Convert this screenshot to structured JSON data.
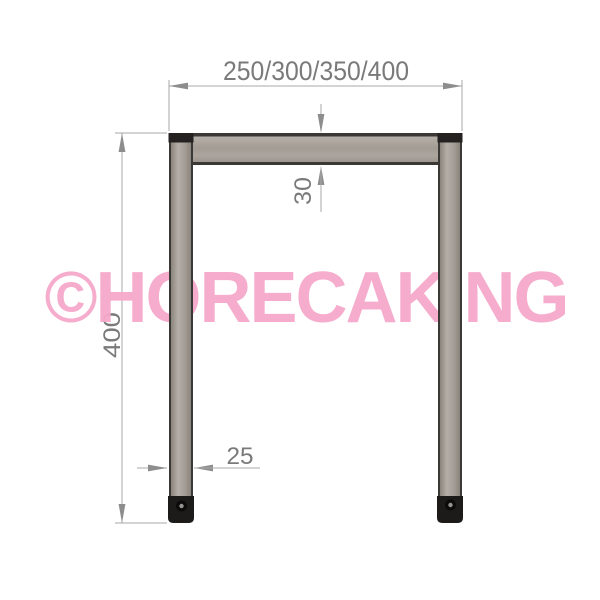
{
  "watermark": {
    "text": "©HORECAKING",
    "color": "#f6a9cb"
  },
  "drawing": {
    "title": "frame-front-view-technical-drawing",
    "dimensions": {
      "top_width_label": "250/300/350/400",
      "profile_height_label": "30",
      "leg_height_label": "400",
      "leg_width_label": "25"
    },
    "units_shown": false
  },
  "colors": {
    "background": "#ffffff",
    "steel_fill": "#a8a29b",
    "steel_edge": "#3b3936",
    "cap_black": "#242120",
    "foot_black": "#1d1b1a",
    "dim_line_gray": "#a9a9a9",
    "dim_arrow_gray": "#8d8d8d",
    "dim_text_gray": "#7a7a7a",
    "watermark_pink": "#f6a9cb"
  }
}
